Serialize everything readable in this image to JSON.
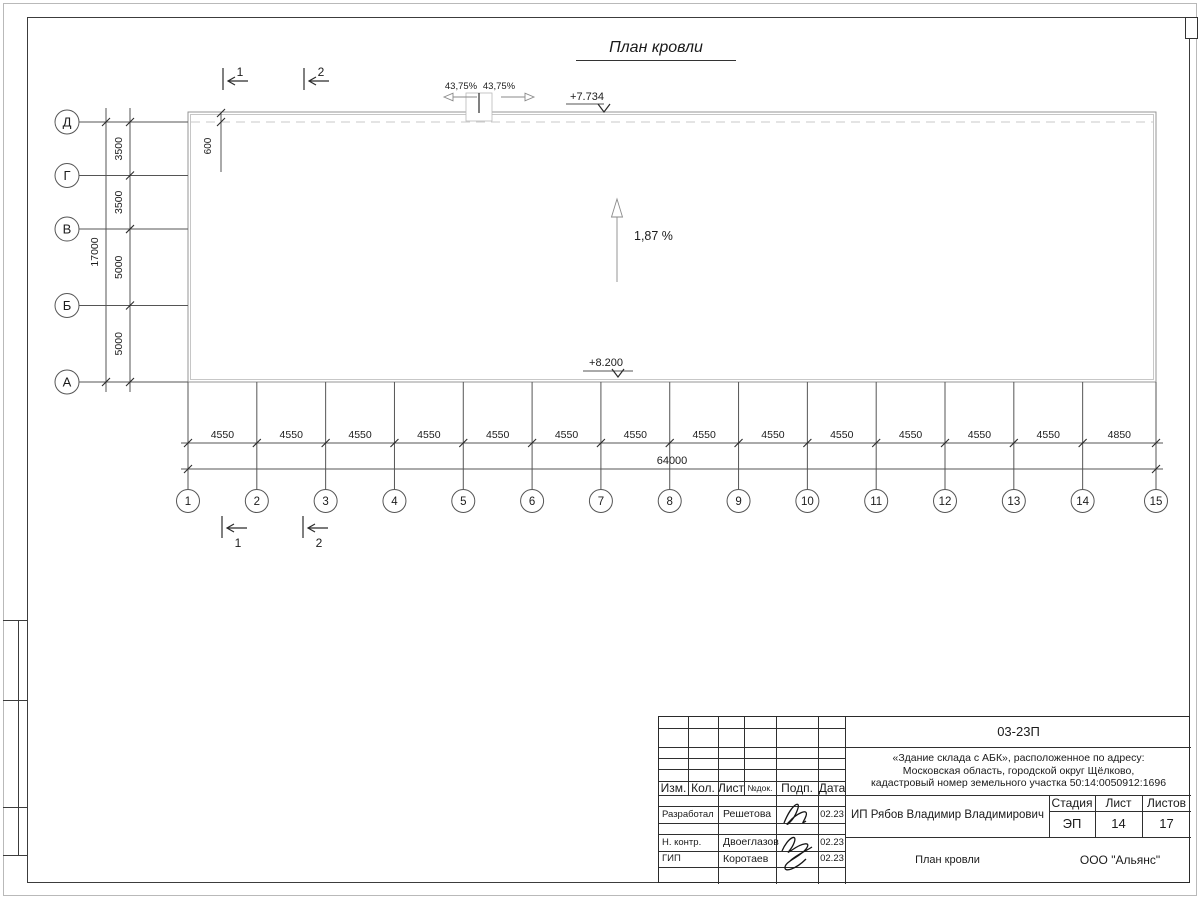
{
  "sheet": {
    "title": "План кровли"
  },
  "plan": {
    "slope_label": "1,87 %",
    "elevation_top": "+7.734",
    "elevation_bottom": "+8.200",
    "ridge_slope_left": "43,75%",
    "ridge_slope_right": "43,75%",
    "parapet_offset_dim": "600",
    "section_top": [
      "1",
      "2"
    ],
    "section_bottom": [
      "1",
      "2"
    ],
    "row_axes": [
      "Д",
      "Г",
      "В",
      "Б",
      "А"
    ],
    "row_spans": [
      "3500",
      "3500",
      "5000",
      "5000"
    ],
    "row_total": "17000",
    "col_axes": [
      "1",
      "2",
      "3",
      "4",
      "5",
      "6",
      "7",
      "8",
      "9",
      "10",
      "11",
      "12",
      "13",
      "14",
      "15"
    ],
    "col_spans": [
      "4550",
      "4550",
      "4550",
      "4550",
      "4550",
      "4550",
      "4550",
      "4550",
      "4550",
      "4550",
      "4550",
      "4550",
      "4550",
      "4850"
    ],
    "col_total": "64000"
  },
  "title_block": {
    "doc_number": "03-23П",
    "project_line1": "«Здание склада с АБК», расположенное по адресу:",
    "project_line2": "Московская область, городской округ Щёлково,",
    "project_line3": "кадастровый номер земельного участка 50:14:0050912:1696",
    "columns": [
      "Изм.",
      "Кол.",
      "Лист",
      "№док.",
      "Подп.",
      "Дата"
    ],
    "signature_rows": [
      {
        "role": "Разработал",
        "name": "Решетова",
        "date": "02.23"
      },
      {
        "role": "Н. контр.",
        "name": "Двоеглазов",
        "date": "02.23"
      },
      {
        "role": "ГИП",
        "name": "Коротаев",
        "date": "02.23"
      }
    ],
    "client": "ИП Рябов Владимир Владимирович",
    "stage_label": "Стадия",
    "sheet_label": "Лист",
    "sheets_label": "Листов",
    "stage_value": "ЭП",
    "sheet_value": "14",
    "sheets_value": "17",
    "sheet_name": "План кровли",
    "organization": "ООО \"Альянс\""
  }
}
